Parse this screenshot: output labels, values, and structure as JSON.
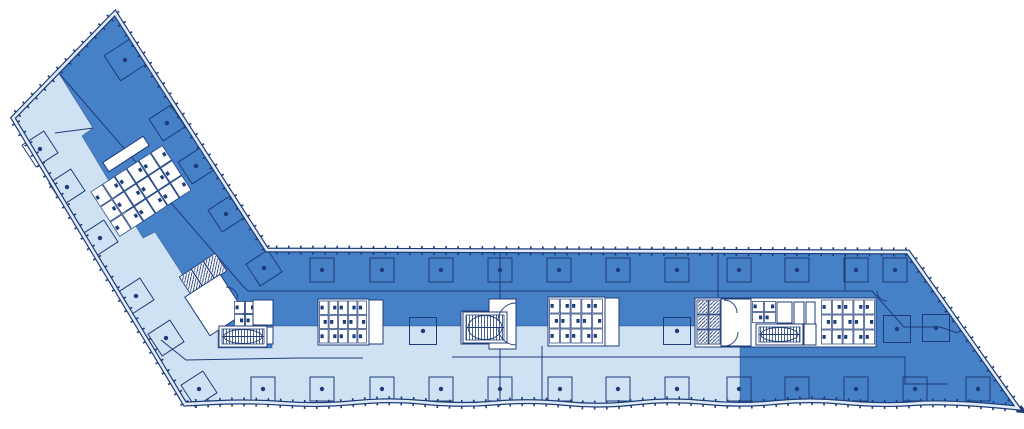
{
  "meta": {
    "width": 1024,
    "height": 429,
    "description": "Architectural floor plan of an angled slab building with a dark blue zone and a light blue zone"
  },
  "colors": {
    "dark": "#4680c6",
    "light": "#cfe2f3",
    "line": "#1e3c78",
    "wall": "#e2ecf8",
    "white": "#ffffff"
  },
  "outline_head": [
    [
      115,
      13
    ],
    [
      267,
      250
    ],
    [
      908,
      252
    ],
    [
      1018,
      408
    ]
  ],
  "outline_wave": [
    [
      950,
      401
    ],
    [
      880,
      406
    ],
    [
      810,
      399
    ],
    [
      740,
      406
    ],
    [
      670,
      399
    ],
    [
      600,
      407
    ],
    [
      530,
      400
    ],
    [
      460,
      406
    ],
    [
      390,
      399
    ],
    [
      320,
      406
    ],
    [
      250,
      401
    ],
    [
      185,
      404
    ]
  ],
  "outline_tail": [
    [
      13,
      118
    ]
  ],
  "light_region": [
    [
      58,
      72
    ],
    [
      93,
      128
    ],
    [
      82,
      136
    ],
    [
      143,
      238
    ],
    [
      155,
      232
    ],
    [
      208,
      314
    ],
    [
      218,
      322
    ],
    [
      218,
      348
    ],
    [
      272,
      348
    ],
    [
      272,
      326
    ],
    [
      740,
      326
    ],
    [
      740,
      406
    ],
    [
      670,
      399
    ],
    [
      600,
      407
    ],
    [
      530,
      400
    ],
    [
      460,
      406
    ],
    [
      390,
      399
    ],
    [
      320,
      406
    ],
    [
      250,
      401
    ],
    [
      185,
      404
    ],
    [
      13,
      118
    ]
  ],
  "lines": [
    {
      "name": "corridor-wing",
      "pts": [
        [
          58,
          72
        ],
        [
          242,
          285
        ],
        [
          248,
          291
        ],
        [
          845,
          291
        ]
      ]
    },
    {
      "name": "partition-v845",
      "pts": [
        [
          845,
          252
        ],
        [
          845,
          291
        ]
      ]
    },
    {
      "name": "partition-right-zig",
      "pts": [
        [
          845,
          291
        ],
        [
          872,
          291
        ],
        [
          904,
          327
        ],
        [
          940,
          327
        ],
        [
          958,
          333
        ]
      ]
    },
    {
      "name": "partition-v718",
      "pts": [
        [
          718,
          251
        ],
        [
          718,
          297
        ]
      ]
    },
    {
      "name": "gridline-v500",
      "pts": [
        [
          500,
          250
        ],
        [
          500,
          406
        ]
      ]
    },
    {
      "name": "partition-v542",
      "pts": [
        [
          542,
          346
        ],
        [
          542,
          403
        ]
      ]
    },
    {
      "name": "corridor-bend",
      "pts": [
        [
          161,
          340
        ],
        [
          186,
          360
        ],
        [
          297,
          358
        ],
        [
          363,
          358
        ]
      ]
    },
    {
      "name": "corridor-low",
      "pts": [
        [
          452,
          357
        ],
        [
          853,
          357
        ],
        [
          905,
          357
        ],
        [
          905,
          384
        ],
        [
          948,
          384
        ]
      ]
    },
    {
      "name": "partition-cap",
      "pts": [
        [
          55,
          133
        ],
        [
          93,
          128
        ]
      ]
    }
  ],
  "columns": {
    "rot_angle": -33,
    "side": 24,
    "dot_r": 2.2,
    "rotated": [
      [
        125,
        60,
        30
      ],
      [
        167,
        123,
        26
      ],
      [
        196,
        166,
        26
      ],
      [
        226,
        214,
        26
      ],
      [
        264,
        268,
        26
      ],
      [
        40,
        149,
        26
      ],
      [
        67,
        187,
        26
      ],
      [
        100,
        238,
        26
      ],
      [
        136,
        296,
        26
      ],
      [
        166,
        338,
        26
      ],
      [
        199,
        389,
        26
      ]
    ],
    "top": {
      "y": 270,
      "xs": [
        322,
        382,
        441,
        500,
        559,
        618,
        677,
        739,
        797,
        856,
        895
      ]
    },
    "bottom": {
      "y": 389,
      "xs": [
        263,
        322,
        382,
        441,
        500,
        560,
        618,
        677,
        739,
        797,
        856,
        915,
        978
      ]
    },
    "mid": [
      [
        423,
        331
      ],
      [
        677,
        331
      ],
      [
        897,
        329
      ],
      [
        936,
        328
      ]
    ]
  },
  "cores": [
    {
      "t": "fix",
      "name": "wing-wc-core",
      "cx": 141,
      "cy": 191,
      "w": 86,
      "h": 54,
      "rot": -33,
      "rows": 3,
      "cols": 6
    },
    {
      "t": "bar",
      "name": "wing-core-bar",
      "cx": 126,
      "cy": 154,
      "w": 48,
      "h": 11,
      "rot": -33
    },
    {
      "t": "cellrow",
      "name": "junction-elevator-bank",
      "w": 14,
      "h": 21,
      "rot": -33,
      "cells": [
        [
          215,
          266
        ],
        [
          203,
          274
        ],
        [
          191,
          282
        ]
      ]
    },
    {
      "t": "bar",
      "name": "junction-lobby",
      "cx": 215,
      "cy": 305,
      "w": 42,
      "h": 46,
      "rot": -33
    },
    {
      "t": "fix",
      "name": "junction-wc",
      "cx": 245,
      "cy": 314,
      "w": 22,
      "h": 26,
      "rot": 0,
      "rows": 2,
      "cols": 2
    },
    {
      "t": "rect",
      "name": "junction-shaft-a",
      "x": 253,
      "y": 300,
      "w": 20,
      "h": 25
    },
    {
      "t": "rect",
      "name": "junction-shaft-b",
      "x": 257,
      "y": 327,
      "w": 16,
      "h": 17
    },
    {
      "t": "stair",
      "name": "junction-stair",
      "x": 219,
      "y": 326,
      "w": 48,
      "h": 21
    },
    {
      "t": "rect",
      "name": "core1-bg",
      "x": 318,
      "y": 299,
      "w": 51,
      "h": 46
    },
    {
      "t": "fix",
      "name": "core1-wc",
      "cx": 343,
      "cy": 322,
      "w": 48,
      "h": 43,
      "rot": 0,
      "rows": 3,
      "cols": 5
    },
    {
      "t": "rect",
      "name": "core1-shaft",
      "x": 369,
      "y": 300,
      "w": 14,
      "h": 44
    },
    {
      "t": "stair",
      "name": "stair-mid",
      "x": 461,
      "y": 311,
      "w": 50,
      "h": 33
    },
    {
      "t": "rect",
      "name": "stair-mid-flank",
      "x": 489,
      "y": 299,
      "w": 27,
      "h": 50
    },
    {
      "t": "stair",
      "name": "stair-mid2",
      "x": 463,
      "y": 312,
      "w": 44,
      "h": 31
    },
    {
      "t": "rect",
      "name": "core2-bg",
      "x": 548,
      "y": 297,
      "w": 57,
      "h": 49
    },
    {
      "t": "fix",
      "name": "core2-wc",
      "cx": 576,
      "cy": 321,
      "w": 54,
      "h": 45,
      "rot": 0,
      "rows": 3,
      "cols": 5
    },
    {
      "t": "rect",
      "name": "core2-shaft",
      "x": 605,
      "y": 298,
      "w": 14,
      "h": 48
    },
    {
      "t": "rect",
      "name": "right-core-bg",
      "x": 695,
      "y": 298,
      "w": 181,
      "h": 49
    },
    {
      "t": "cellgrid",
      "name": "right-elevator-bank",
      "x": 697,
      "y": 300,
      "cols": 2,
      "rows": 3,
      "cw": 11,
      "ch": 14,
      "gx": 1,
      "gy": 1
    },
    {
      "t": "rect",
      "name": "right-lobby",
      "x": 721,
      "y": 299,
      "w": 30,
      "h": 47
    },
    {
      "t": "fix",
      "name": "right-wc-small",
      "cx": 764,
      "cy": 312,
      "w": 24,
      "h": 22,
      "rot": 0,
      "rows": 2,
      "cols": 2
    },
    {
      "t": "rect",
      "name": "right-room-a",
      "x": 777,
      "y": 302,
      "w": 15,
      "h": 21
    },
    {
      "t": "rect",
      "name": "right-room-b",
      "x": 794,
      "y": 302,
      "w": 10,
      "h": 22
    },
    {
      "t": "rect",
      "name": "right-room-c",
      "x": 806,
      "y": 302,
      "w": 9,
      "h": 22
    },
    {
      "t": "stair",
      "name": "right-stair",
      "x": 756,
      "y": 324,
      "w": 47,
      "h": 21
    },
    {
      "t": "rect",
      "name": "right-shaft",
      "x": 804,
      "y": 324,
      "w": 12,
      "h": 21
    },
    {
      "t": "fix",
      "name": "right-wc-large",
      "cx": 848,
      "cy": 322,
      "w": 54,
      "h": 45,
      "rot": 0,
      "rows": 3,
      "cols": 5
    }
  ],
  "arcs": [
    [
      516,
      303,
      498,
      321,
      18,
      0
    ],
    [
      516,
      345,
      498,
      327,
      18,
      1
    ],
    [
      724,
      300,
      737,
      313,
      13,
      1
    ],
    [
      724,
      346,
      738,
      332,
      14,
      0
    ],
    [
      877,
      291,
      887,
      301,
      10,
      0
    ],
    [
      226,
      287,
      238,
      299,
      12,
      1
    ]
  ]
}
